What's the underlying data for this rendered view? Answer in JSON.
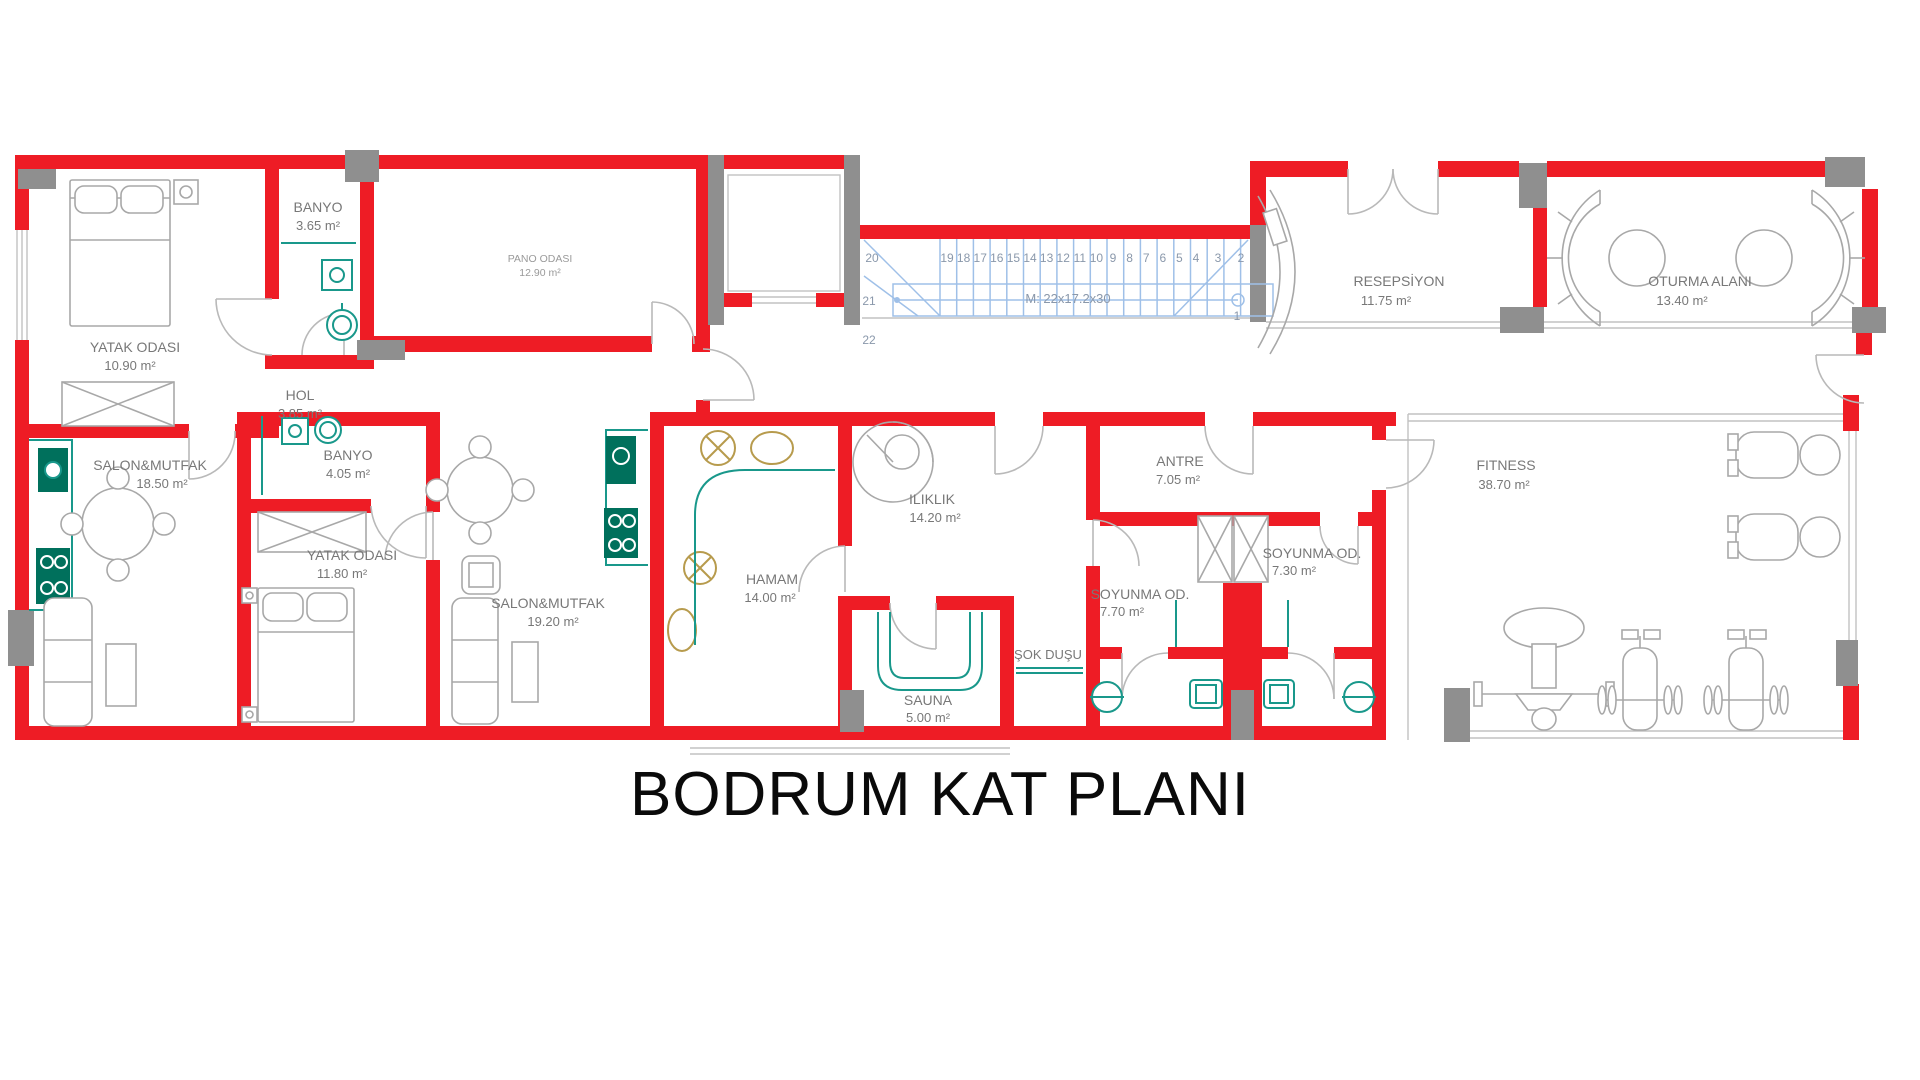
{
  "title": "BODRUM KAT PLANI",
  "colors": {
    "wall": "#ee1c25",
    "column": "#8f8f8f",
    "furniture": "#a8a8a8",
    "fixture_teal": "#19988b",
    "fixture_green": "#00705c",
    "fixture_gold": "#b79b4d",
    "stair_lines": "#9fc0e8",
    "stair_text": "#8a98ab",
    "room_label": "#787878",
    "title_text": "#0a0a0a"
  },
  "rooms": {
    "yatak1": {
      "name": "YATAK ODASI",
      "area": "10.90 m²"
    },
    "banyo1": {
      "name": "BANYO",
      "area": "3.65 m²"
    },
    "pano": {
      "name": "PANO ODASI",
      "area": "12.90 m²"
    },
    "hol": {
      "name": "HOL",
      "area": "3.85 m²"
    },
    "salon1": {
      "name": "SALON&MUTFAK",
      "area": "18.50 m²"
    },
    "banyo2": {
      "name": "BANYO",
      "area": "4.05 m²"
    },
    "yatak2": {
      "name": "YATAK ODASI",
      "area": "11.80 m²"
    },
    "salon2": {
      "name": "SALON&MUTFAK",
      "area": "19.20 m²"
    },
    "hamam": {
      "name": "HAMAM",
      "area": "14.00 m²"
    },
    "iliklik": {
      "name": "ILIKLIK",
      "area": "14.20 m²"
    },
    "sauna": {
      "name": "SAUNA",
      "area": "5.00 m²"
    },
    "sokdusu": {
      "name": "ŞOK DUŞU",
      "area": ""
    },
    "soyunma1": {
      "name": "SOYUNMA OD.",
      "area": "7.70 m²"
    },
    "soyunma2": {
      "name": "SOYUNMA OD.",
      "area": "7.30 m²"
    },
    "antre": {
      "name": "ANTRE",
      "area": "7.05 m²"
    },
    "fitness": {
      "name": "FITNESS",
      "area": "38.70 m²"
    },
    "resepsiyon": {
      "name": "RESEPSİYON",
      "area": "11.75 m²"
    },
    "oturma": {
      "name": "OTURMA ALANI",
      "area": "13.40 m²"
    }
  },
  "stairs": {
    "numbers": [
      "1",
      "2",
      "3",
      "4",
      "5",
      "6",
      "7",
      "8",
      "9",
      "10",
      "11",
      "12",
      "13",
      "14",
      "15",
      "16",
      "17",
      "18",
      "19",
      "20",
      "21",
      "22"
    ],
    "annotation": "M: 22x17.2x30"
  }
}
